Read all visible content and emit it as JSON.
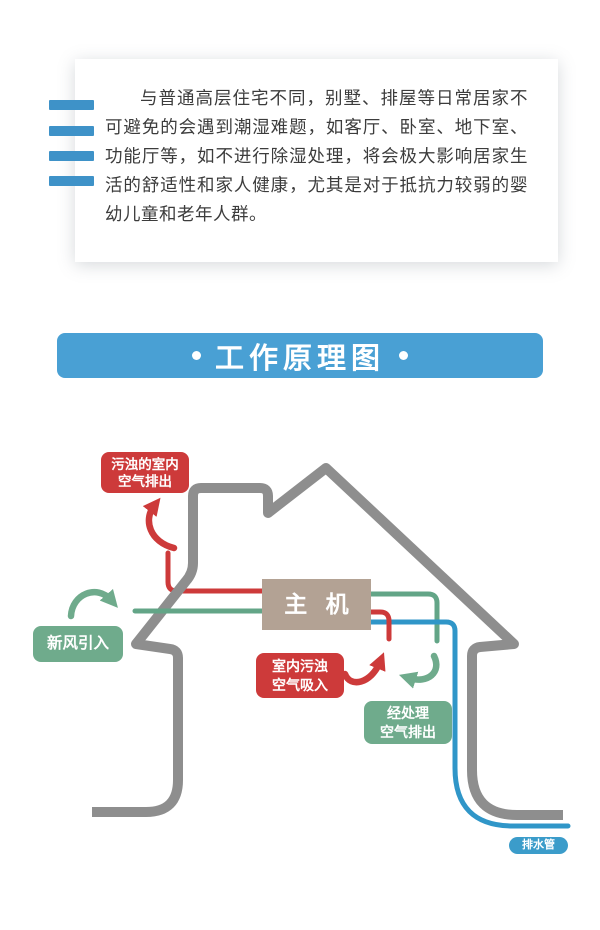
{
  "intro_card": {
    "paragraph": "与普通高层住宅不同，别墅、排屋等日常居家不可避免的会遇到潮湿难题，如客厅、卧室、地下室、功能厅等，如不进行除湿处理，将会极大影响居家生活的舒适性和家人健康，尤其是对于抵抗力较弱的婴幼儿童和老年人群。",
    "accent_bar_color": "#3e92c8",
    "text_color": "#3c3c3c"
  },
  "section_banner": {
    "title": "工作原理图",
    "background": "#49a0d4",
    "text_color": "#ffffff"
  },
  "diagram": {
    "colors": {
      "house_outline": "#8e8e8e",
      "exhaust_red": "#cd3a3a",
      "fresh_green": "#63a587",
      "drain_blue": "#3096c8",
      "main_unit_tan": "#b3a294"
    },
    "labels": {
      "dirty_air_out": {
        "line1": "污浊的室内",
        "line2": "空气排出"
      },
      "fresh_air_in": {
        "text": "新风引入"
      },
      "main_unit": {
        "text": "主 机"
      },
      "dirty_air_in": {
        "line1": "室内污浊",
        "line2": "空气吸入"
      },
      "treated_air_out": {
        "line1": "经处理",
        "line2": "空气排出"
      },
      "drain_pipe": {
        "text": "排水管"
      }
    }
  }
}
